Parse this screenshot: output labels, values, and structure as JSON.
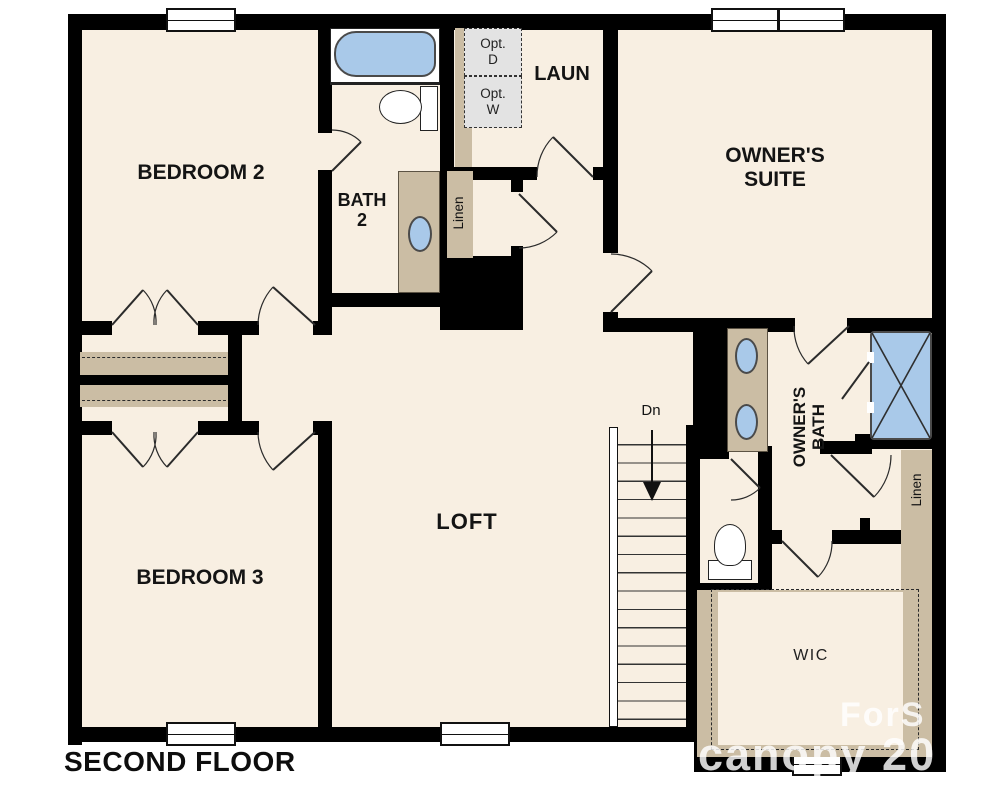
{
  "plan": {
    "floor_title": "SECOND FLOOR",
    "rooms": {
      "bedroom2": "BEDROOM 2",
      "bedroom3": "BEDROOM 3",
      "owners_suite_l1": "OWNER'S",
      "owners_suite_l2": "SUITE",
      "bath2_l1": "BATH",
      "bath2_l2": "2",
      "laundry": "LAUN",
      "loft": "LOFT",
      "owners_bath_l1": "OWNER'S",
      "owners_bath_l2": "BATH",
      "wic": "WIC"
    },
    "labels": {
      "linen_hall": "Linen",
      "linen_owners": "Linen",
      "stairs_down": "Dn",
      "opt_dryer_l1": "Opt.",
      "opt_dryer_l2": "D",
      "opt_washer_l1": "Opt.",
      "opt_washer_l2": "W"
    },
    "watermark": {
      "fragment_top": "ForS",
      "fragment_bottom": "canopy 20"
    },
    "colors": {
      "floor": "#f8efe2",
      "wall": "#000000",
      "cabinet_tan": "#cbbda4",
      "fixture_blue": "#a9c9e9",
      "appliance_gray": "#e3e3e3"
    }
  }
}
